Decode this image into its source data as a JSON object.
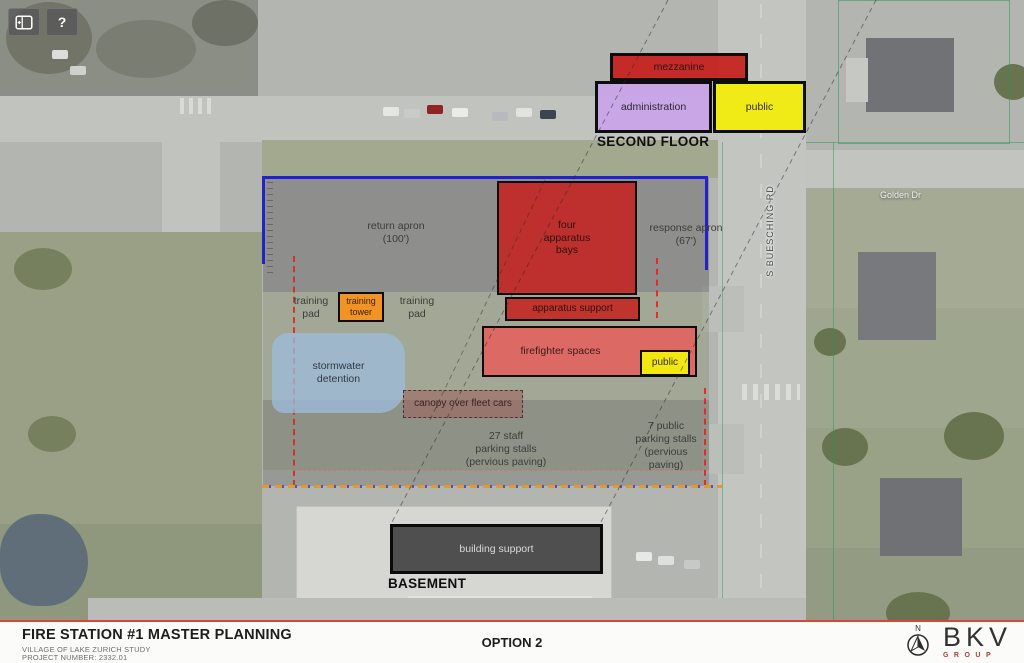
{
  "toolbar": {
    "help_button": "?"
  },
  "second_floor": {
    "title": "SECOND FLOOR",
    "mezzanine": "mezzanine",
    "administration": "administration",
    "public": "public"
  },
  "first_floor": {
    "return_apron": "return apron\n(100')",
    "response_apron": "response apron\n(67')",
    "four_apparatus_bays": "four\napparatus\nbays",
    "apparatus_support": "apparatus support",
    "training_pad_left": "training\npad",
    "training_tower": "training\ntower",
    "training_pad_right": "training\npad",
    "stormwater_detention": "stormwater\ndetention",
    "firefighter_spaces": "firefighter spaces",
    "public": "public",
    "canopy": "canopy over fleet cars",
    "staff_parking": "27 staff\nparking stalls\n(pervious paving)",
    "public_parking": "7 public\nparking stalls\n(pervious\npaving)"
  },
  "basement": {
    "title": "BASEMENT",
    "building_support": "building support"
  },
  "streets": {
    "buesching_rd": "S BUESCHING RD",
    "golden_dr": "Golden Dr"
  },
  "title_block": {
    "project_title": "FIRE STATION #1 MASTER PLANNING",
    "subtitle_1": "VILLAGE OF LAKE ZURICH STUDY",
    "subtitle_2": "PROJECT NUMBER: 2332.01",
    "option_label": "OPTION 2",
    "north_label": "N",
    "logo_main": "BKV",
    "logo_sub": "GROUP"
  },
  "colors": {
    "red_block": "#c6201c",
    "salmon_block": "#e4605c",
    "purple_block": "#c9a5e8",
    "yellow_block": "#f2ec0e",
    "orange_block": "#f6921e",
    "canopy_block": "#9e5c58",
    "stormwater_block": "#9ebcdc",
    "dark_block": "#343434",
    "site_outline_blue": "#2322c9",
    "boundary_red": "#e02020",
    "accent_red": "#d8453c"
  }
}
